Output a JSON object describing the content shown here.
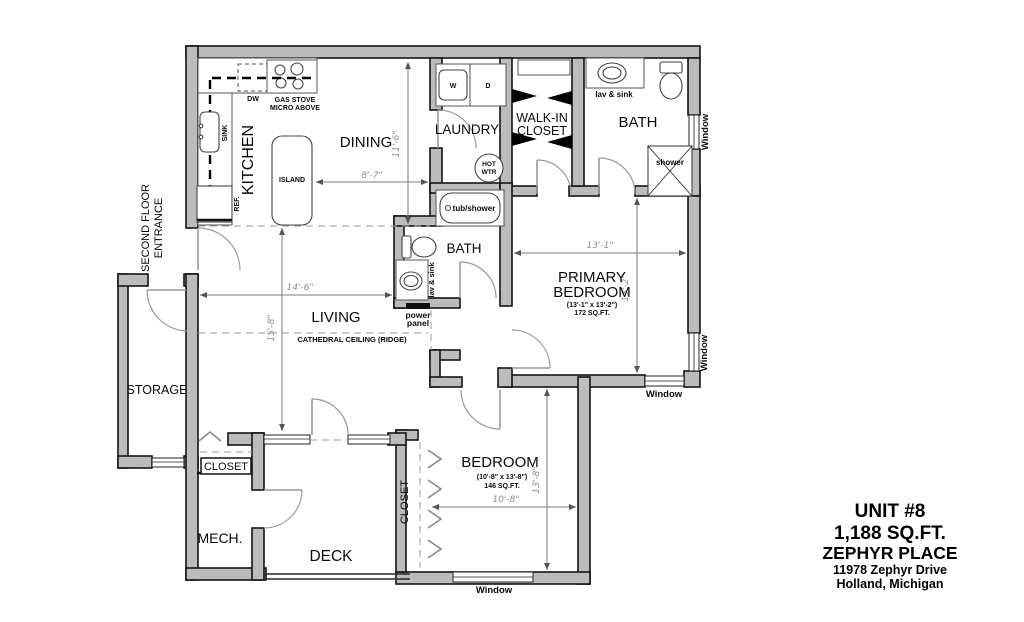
{
  "plan": {
    "rooms": {
      "kitchen": "KITCHEN",
      "dining": "DINING",
      "laundry": "LAUNDRY",
      "walkin_line1": "WALK-IN",
      "walkin_line2": "CLOSET",
      "bath_top": "BATH",
      "bath_mid": "BATH",
      "living": "LIVING",
      "primary_line1": "PRIMARY",
      "primary_line2": "BEDROOM",
      "primary_dims": "(13'-1\" x 13'-2\")",
      "primary_area": "172 SQ.FT.",
      "bedroom": "BEDROOM",
      "bedroom_dims": "(10'-8\" x 13'-8\")",
      "bedroom_area": "146 SQ.FT.",
      "storage": "STORAGE",
      "closet": "CLOSET",
      "closet_bedroom": "CLOSET",
      "mech": "MECH.",
      "deck": "DECK",
      "entrance_line1": "SECOND FLOOR",
      "entrance_line2": "ENTRANCE"
    },
    "fixtures": {
      "dw": "DW",
      "stove_line1": "GAS STOVE",
      "stove_line2": "MICRO ABOVE",
      "sink": "SINK",
      "ref": "REF.",
      "island": "ISLAND",
      "washer": "W",
      "dryer": "D",
      "hot_line1": "HOT",
      "hot_line2": "WTR",
      "tub": "tub/shower",
      "lav_top": "lav & sink",
      "lav_mid": "lav & sink",
      "shower": "shower",
      "power_line1": "power",
      "power_line2": "panel",
      "ceiling": "CATHEDRAL CEILING (RIDGE)"
    },
    "dims": {
      "dining_w": "8'-7\"",
      "dining_h": "11'-6\"",
      "living_w": "14'-6\"",
      "living_h": "15'-8\"",
      "primary_w": "13'-1\"",
      "primary_h": "13'-2\"",
      "bedroom_w": "10'-8\"",
      "bedroom_h": "13'-8\""
    },
    "window_labels": {
      "bath_right": "Window",
      "primary_right": "Window",
      "primary_bottom": "Window",
      "bedroom_bottom": "Window"
    }
  },
  "title_block": {
    "unit": "UNIT #8",
    "area": "1,188 SQ.FT.",
    "project": "ZEPHYR PLACE",
    "address_line1": "11978 Zephyr Drive",
    "address_line2": "Holland, Michigan"
  }
}
